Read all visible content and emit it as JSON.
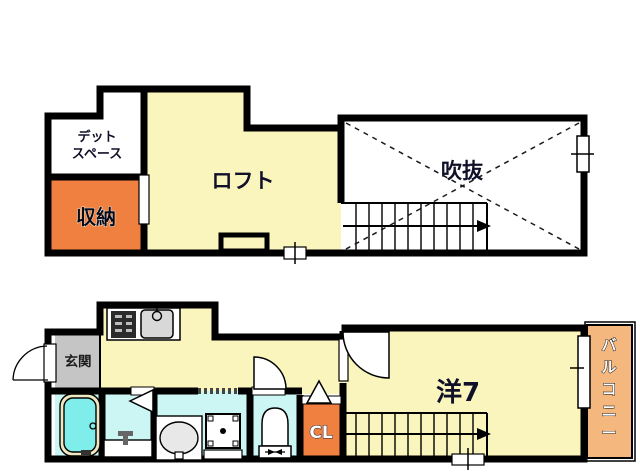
{
  "plan_title": "2-story apartment floor plan",
  "colors": {
    "wall": "#000000",
    "room_yellow": "#FAF5BD",
    "accent_orange": "#F0803F",
    "balcony_orange": "#F4B87E",
    "entrance_gray": "#C5C5C5",
    "wet_room_cyan": "#CBF6F4",
    "bathtub_cyan": "#7FEEEB",
    "tub_rim": "#EFE7C1",
    "sink_gray": "#D8D8D8",
    "stove_dark": "#2B2B2B",
    "label_dark": "#101028",
    "white": "#FFFFFF"
  },
  "upper_floor": {
    "dead_space_line1": "デット",
    "dead_space_line2": "スペース",
    "storage": "収納",
    "loft": "ロフト",
    "void": "吹抜"
  },
  "lower_floor": {
    "entrance": "玄関",
    "western_room": "洋7",
    "closet": "CL",
    "balcony_chars": [
      "バ",
      "ル",
      "コ",
      "ニ",
      "ー"
    ]
  }
}
